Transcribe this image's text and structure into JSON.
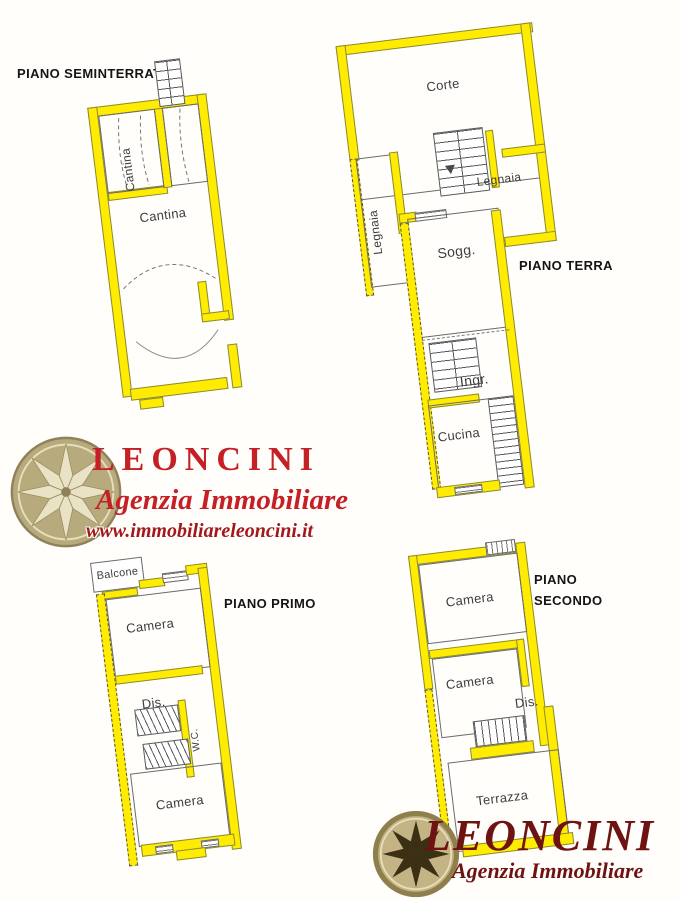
{
  "floors": {
    "seminterrato": {
      "title": "PIANO SEMINTERRATO",
      "rooms": {
        "cantina_small": "Cantina",
        "cantina_main": "Cantina"
      }
    },
    "terra": {
      "title": "PIANO TERRA",
      "rooms": {
        "corte": "Corte",
        "legnaia_left": "Legnaia",
        "legnaia_right": "Legnaia",
        "soggiorno": "Sogg.",
        "ingresso": "Ingr.",
        "cucina": "Cucina"
      }
    },
    "primo": {
      "title": "PIANO PRIMO",
      "rooms": {
        "balcone": "Balcone",
        "camera_top": "Camera",
        "disimpegno": "Dis.",
        "wc": "W.C.",
        "camera_bottom": "Camera"
      }
    },
    "secondo": {
      "title": "PIANO SECONDO",
      "rooms": {
        "camera_top": "Camera",
        "camera_middle": "Camera",
        "disimpegno": "Dis.",
        "terrazza": "Terrazza"
      }
    }
  },
  "agency": {
    "logo_main": {
      "name": "LEONCINI",
      "tagline": "Agenzia Immobiliare",
      "website": "www.immobiliareleoncini.it"
    },
    "logo_footer": {
      "name": "LEONCINI",
      "tagline": "Agenzia Immobiliare"
    }
  },
  "colors": {
    "wall_highlight": "#ffec00",
    "logo_red": "#c42025",
    "logo_maroon": "#6e1212",
    "plan_line": "#5a5a5a"
  }
}
